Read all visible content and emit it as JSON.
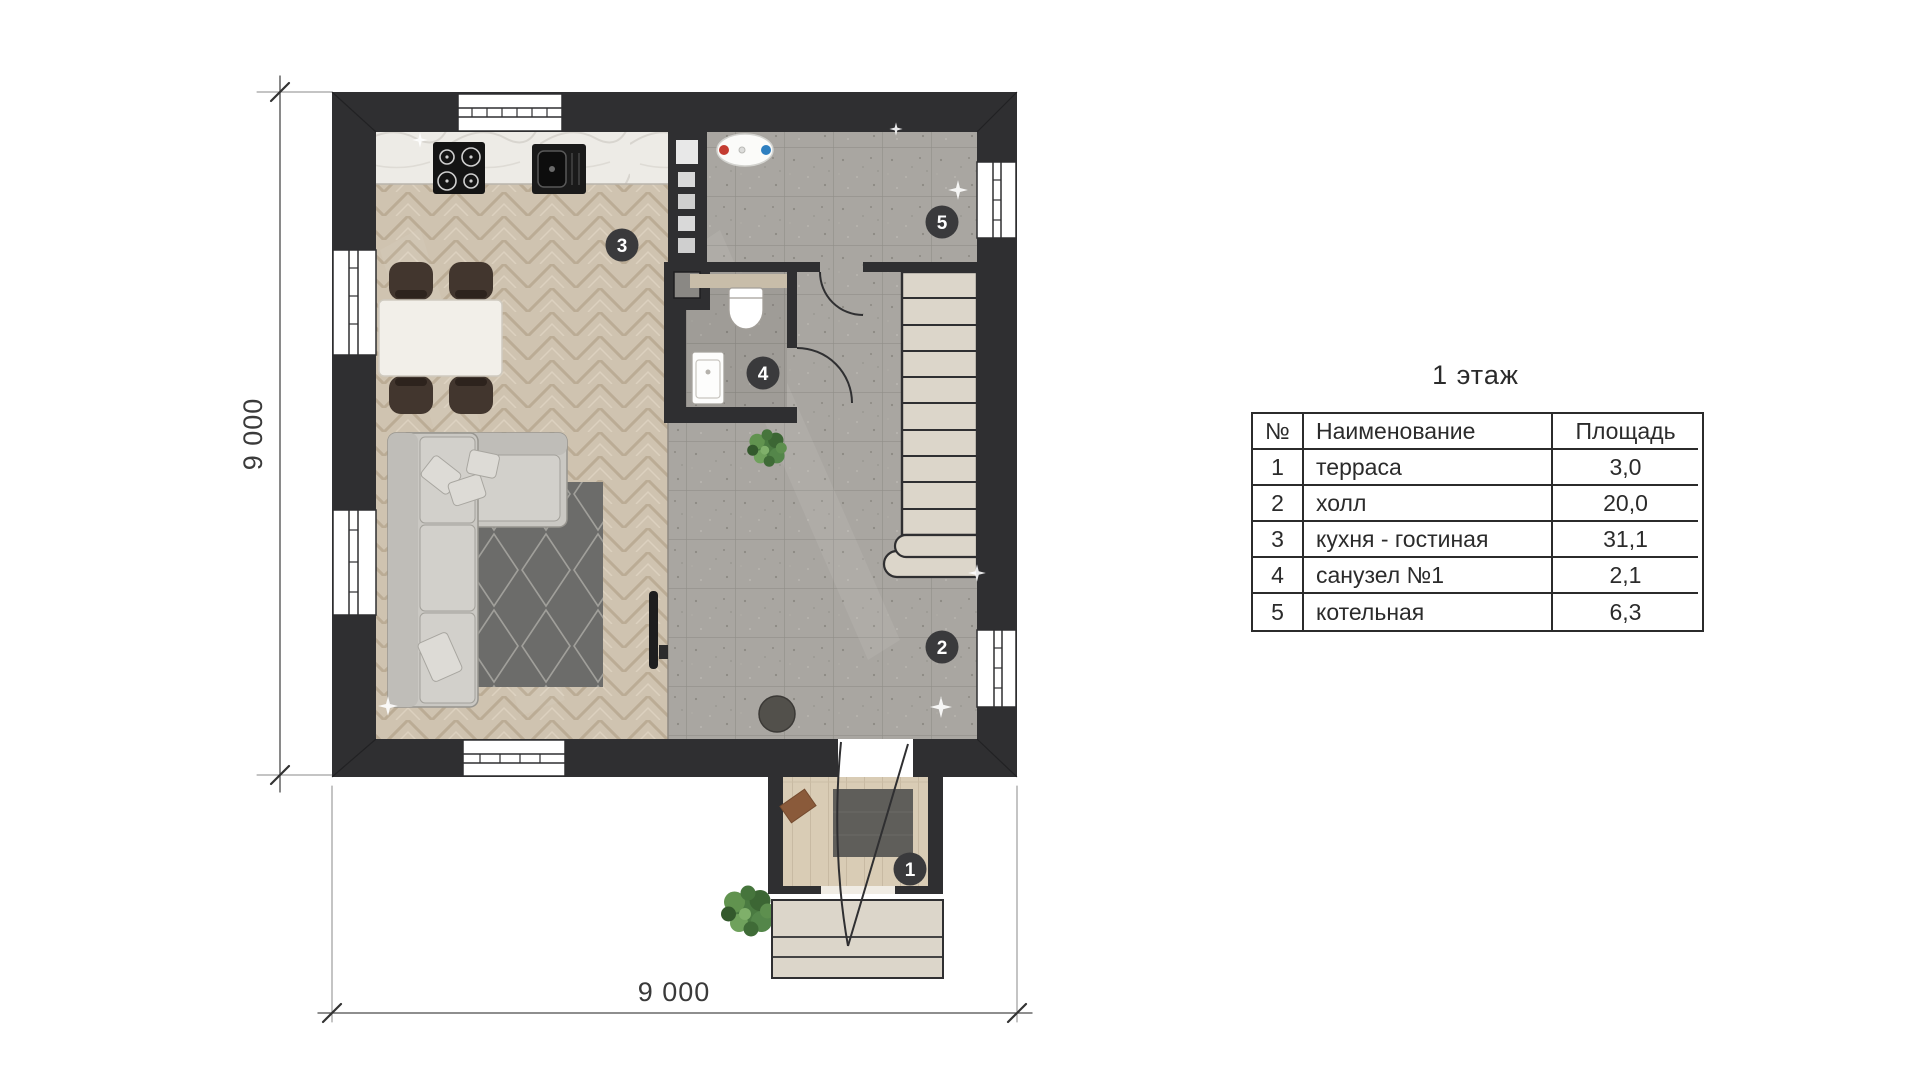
{
  "page": {
    "background": "#ffffff"
  },
  "header": {
    "title": "1 этаж"
  },
  "table": {
    "columns": {
      "num": "№",
      "name": "Наименование",
      "area": "Площадь"
    },
    "rows": [
      {
        "num": "1",
        "name": "терраса",
        "area": "3,0"
      },
      {
        "num": "2",
        "name": "холл",
        "area": "20,0"
      },
      {
        "num": "3",
        "name": "кухня - гостиная",
        "area": "31,1"
      },
      {
        "num": "4",
        "name": "санузел №1",
        "area": "2,1"
      },
      {
        "num": "5",
        "name": "котельная",
        "area": "6,3"
      }
    ]
  },
  "dimensions": {
    "left_label": "9 000",
    "bottom_label": "9 000"
  },
  "plan": {
    "markers": [
      {
        "num": "1"
      },
      {
        "num": "2"
      },
      {
        "num": "3"
      },
      {
        "num": "4"
      },
      {
        "num": "5"
      }
    ],
    "colors": {
      "wall": "#2f2f31",
      "parquet": "#cfc3b0",
      "tile": "#a9a6a1",
      "stair": "#dcd6ca",
      "marker": "#3a3a3c",
      "heater_hot": "#c43c31",
      "heater_cold": "#2e7fc0"
    }
  }
}
